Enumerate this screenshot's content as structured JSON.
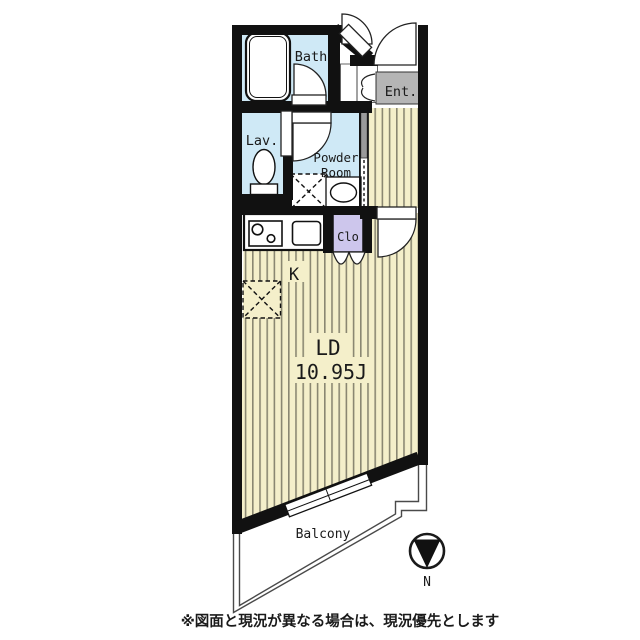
{
  "plan": {
    "rooms": {
      "bath": "Bath",
      "lav": "Lav.",
      "powder_line1": "Powder",
      "powder_line2": "Room",
      "ent": "Ent.",
      "clo": "Clo",
      "kitchen": "K",
      "ld": "LD",
      "ld_size": "10.95J",
      "balcony": "Balcony"
    },
    "compass": {
      "label": "N"
    },
    "note": "※図面と現況が異なる場合は、現況優先とします",
    "colors": {
      "wet_area": "#cfe9f6",
      "entrance": "#b5b5b5",
      "closet": "#cdc6ec",
      "floor": "#f4efca",
      "floor_stripe": "#8a8772",
      "wall": "#111111"
    }
  }
}
